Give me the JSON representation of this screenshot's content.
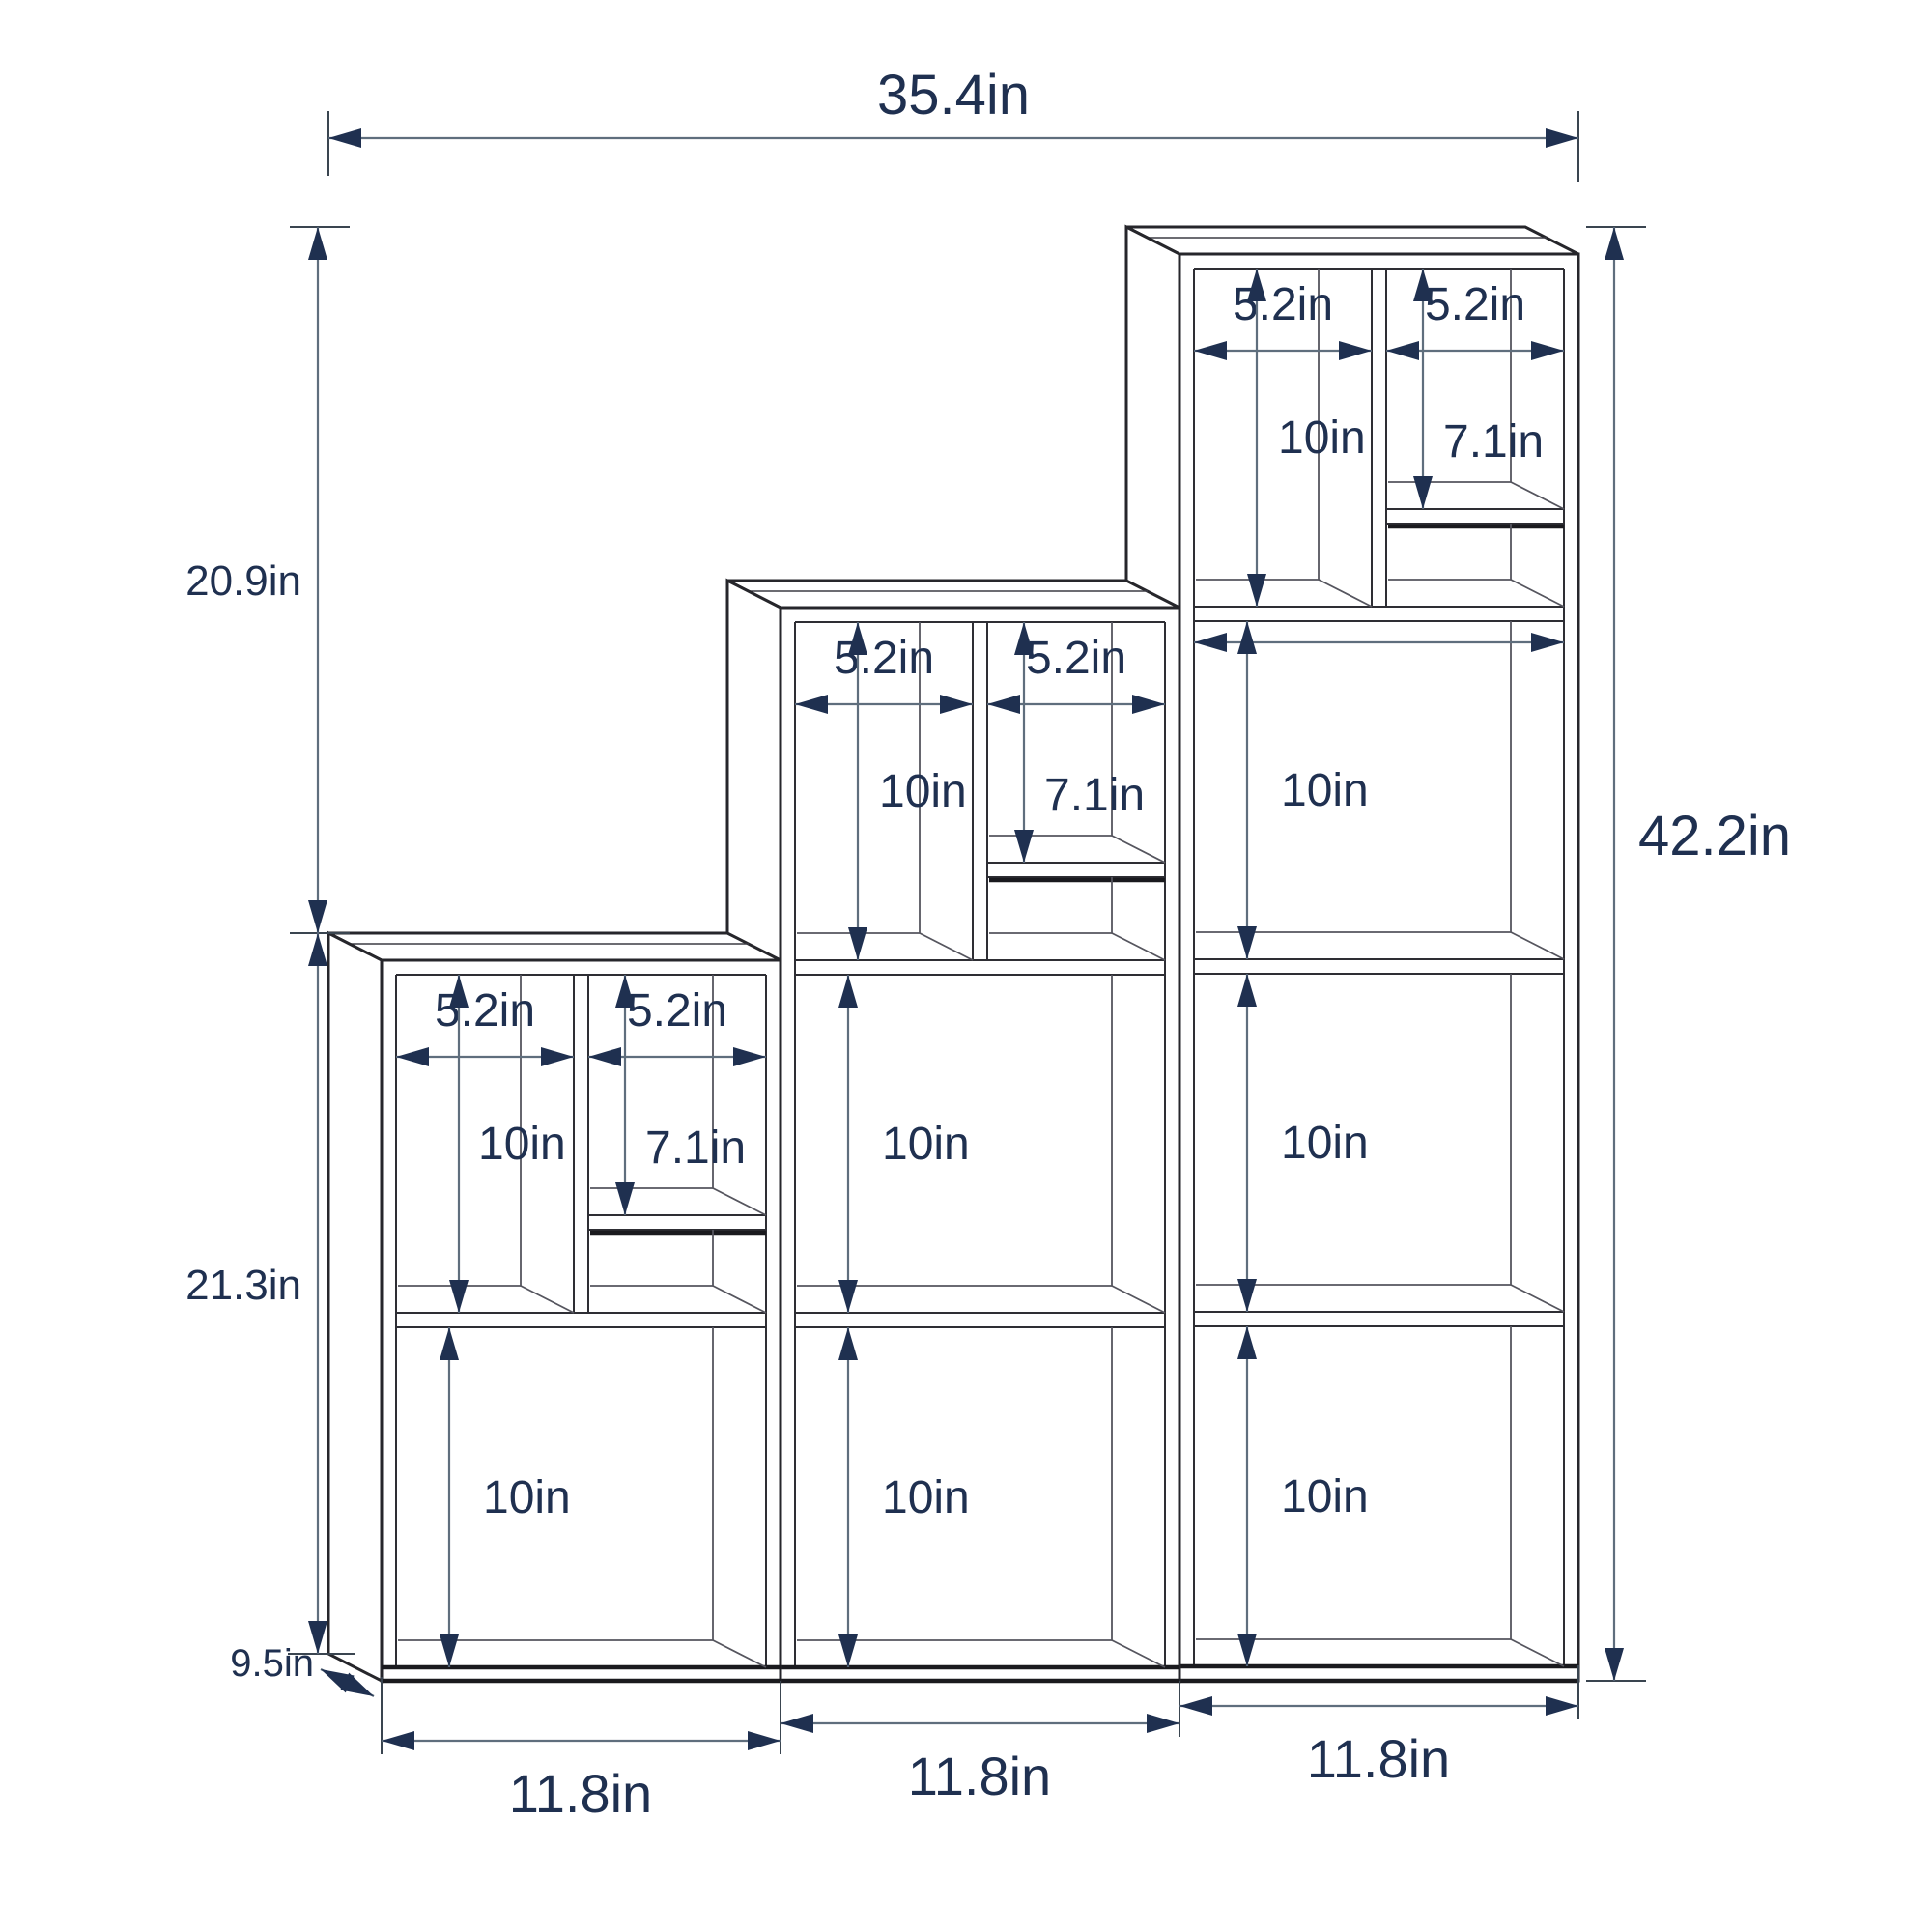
{
  "diagram": {
    "type": "furniture-dimension-diagram",
    "product": "3-tier step cube bookshelf",
    "overall": {
      "width": "35.4in",
      "height": "42.2in",
      "depth": "9.5in",
      "left_column_height": "21.3in",
      "left_upper_offset": "20.9in"
    },
    "units": [
      {
        "name": "left-unit",
        "bottom_width": "11.8in",
        "small_left_width": "5.2in",
        "small_right_width": "5.2in",
        "small_left_height": "10in",
        "small_right_height": "7.1in",
        "rows": [
          "10in"
        ]
      },
      {
        "name": "middle-unit",
        "bottom_width": "11.8in",
        "small_left_width": "5.2in",
        "small_right_width": "5.2in",
        "small_left_height": "10in",
        "small_right_height": "7.1in",
        "rows": [
          "10in",
          "10in"
        ]
      },
      {
        "name": "right-unit",
        "bottom_width": "11.8in",
        "small_left_width": "5.2in",
        "small_right_width": "5.2in",
        "small_left_height": "10in",
        "small_right_height": "7.1in",
        "rows": [
          "10in",
          "10in",
          "10in"
        ]
      }
    ],
    "colors": {
      "label": "#1f3050",
      "dim_line": "#5f6e7d",
      "arrow": "#1f3050",
      "edge": "#26262b",
      "background": "#ffffff"
    }
  }
}
